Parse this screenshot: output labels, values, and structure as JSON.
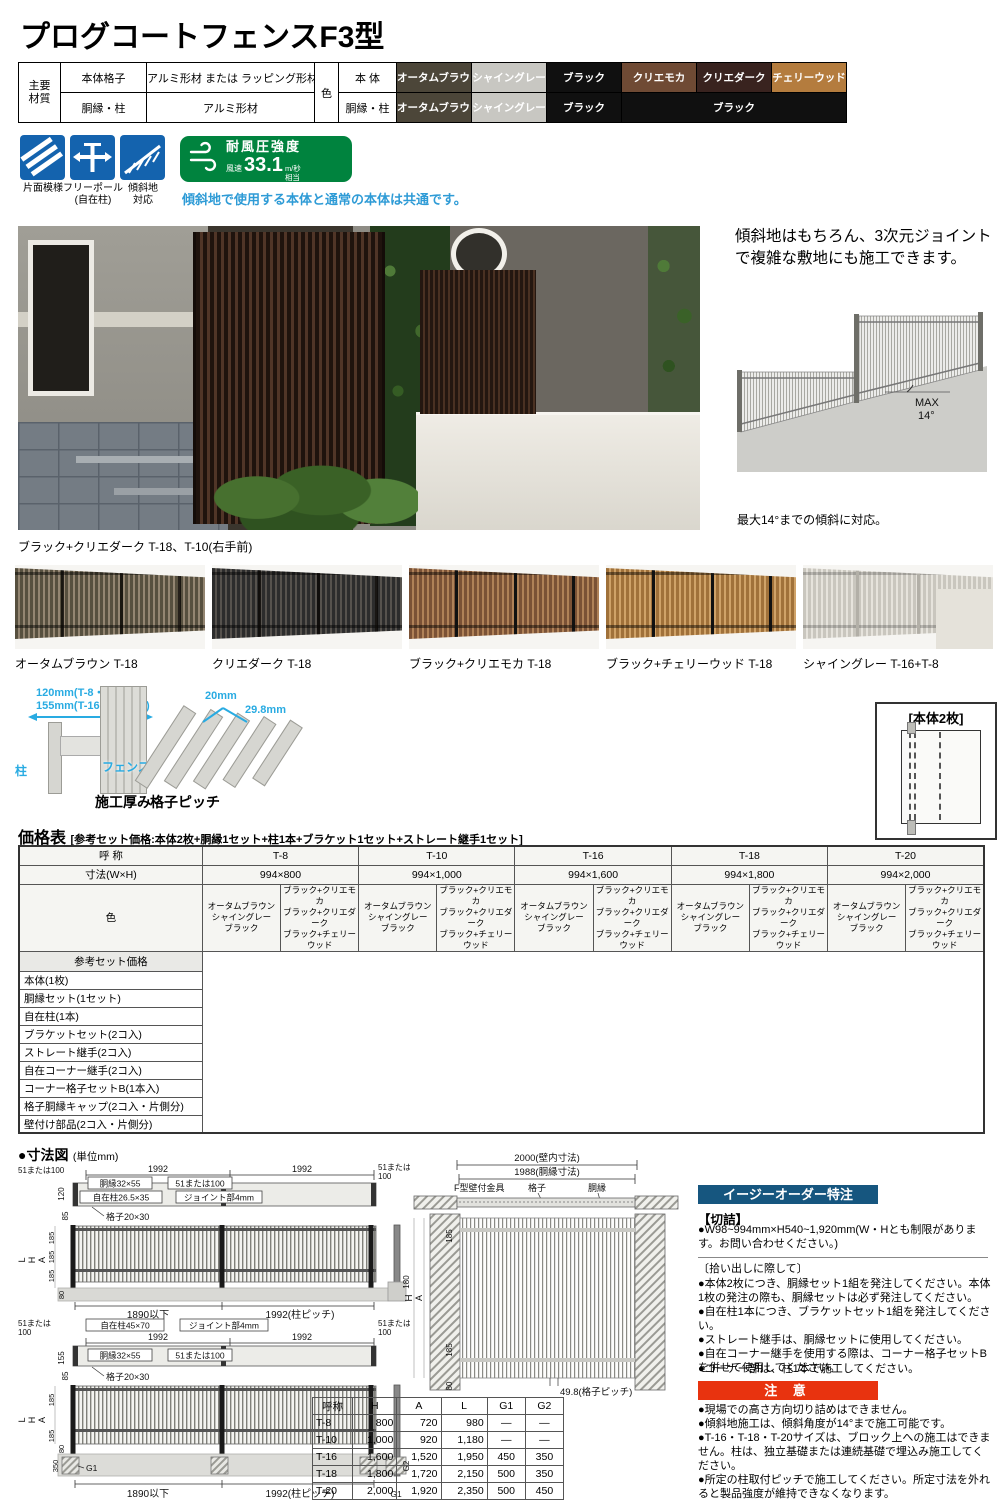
{
  "page": {
    "title": "プログコートフェンスF3型"
  },
  "colors": {
    "icon_blue": "#1463ae",
    "badge_green": "#00833e",
    "note_blue": "#2e9bd6",
    "easy_order_bar": "#16567f",
    "caution_bar": "#e8330f",
    "dim_cyan": "#29abe2"
  },
  "materials": {
    "group_label": "主要\n材質",
    "rows": [
      {
        "part": "本体格子",
        "material": "アルミ形材 または ラッピング形材"
      },
      {
        "part": "胴縁・柱",
        "material": "アルミ形材"
      }
    ],
    "color_label": "色",
    "body_label": "本 体",
    "frame_label": "胴縁・柱",
    "body_colors": [
      {
        "label": "オータムブラウン",
        "bg": "#4c4639"
      },
      {
        "label": "シャイングレー",
        "bg": "#c8c7c2"
      },
      {
        "label": "ブラック",
        "bg": "#101010"
      },
      {
        "label": "クリエモカ",
        "bg": "#6f4a34"
      },
      {
        "label": "クリエダーク",
        "bg": "#39231f"
      },
      {
        "label": "チェリーウッド",
        "bg": "#b47c3e"
      }
    ],
    "frame_colors": [
      {
        "label": "オータムブラウン",
        "bg": "#4c4639"
      },
      {
        "label": "シャイングレー",
        "bg": "#c8c7c2"
      },
      {
        "label": "ブラック",
        "bg": "#101010"
      },
      {
        "label": "ブラック",
        "bg": "#101010"
      }
    ]
  },
  "features": {
    "icons": [
      {
        "label": "片面模様"
      },
      {
        "label": "フリーポール\n(自在柱)"
      },
      {
        "label": "傾斜地\n対応"
      }
    ],
    "badge": {
      "title": "耐風圧強度",
      "prefix": "風速",
      "value": "33.1",
      "unit": "m/秒",
      "suffix": "相当"
    },
    "note": "傾斜地で使用する本体と通常の本体は共通です。"
  },
  "hero": {
    "caption": "ブラック+クリエダーク T-18、T-10(右手前)"
  },
  "slope": {
    "line1": "傾斜地はもちろん、3次元ジョイント",
    "line2": "で複雑な敷地にも施工できます。",
    "max1": "MAX",
    "max2": "14°",
    "caption": "最大14°までの傾斜に対応。"
  },
  "variations": [
    {
      "label": "オータムブラウン T-18"
    },
    {
      "label": "クリエダーク T-18"
    },
    {
      "label": "ブラック+クリエモカ T-18"
    },
    {
      "label": "ブラック+チェリーウッド T-18"
    },
    {
      "label": "シャイングレー T-16+T-8"
    }
  ],
  "detail": {
    "thickness": {
      "dim1": "120mm(T-8・10)",
      "dim2": "155mm(T-16・18・20)",
      "post": "柱",
      "fence": "フェンス",
      "caption": "施工厚み"
    },
    "pitch": {
      "dim1": "20mm",
      "dim2": "29.8mm",
      "caption": "格子ピッチ"
    },
    "panel_box": {
      "title": "[本体2枚]"
    }
  },
  "price_table": {
    "title": "価格表",
    "subtitle": "[参考セット価格:本体2枚+胴縁1セット+柱1本+ブラケット1セット+ストレート継手1セット]",
    "col_name": "呼 称",
    "col_dim": "寸法(W×H)",
    "col_color": "色",
    "sizes": [
      {
        "name": "T-8",
        "dim": "994×800"
      },
      {
        "name": "T-10",
        "dim": "994×1,000"
      },
      {
        "name": "T-16",
        "dim": "994×1,600"
      },
      {
        "name": "T-18",
        "dim": "994×1,800"
      },
      {
        "name": "T-20",
        "dim": "994×2,000"
      }
    ],
    "color_a": "オータムブラウン\nシャイングレー\nブラック",
    "color_b": "ブラック+クリエモカ\nブラック+クリエダーク\nブラック+チェリーウッド",
    "row_headers": [
      "参考セット価格",
      "本体(1枚)",
      "胴縁セット(1セット)",
      "自在柱(1本)",
      "ブラケットセット(2コ入)",
      "ストレート継手(2コ入)",
      "自在コーナー継手(2コ入)",
      "コーナー格子セットB(1本入)",
      "格子胴縁キャップ(2コ入・片側分)",
      "壁付け部品(2コ入・片側分)"
    ]
  },
  "dims_section": {
    "title": "●寸法図",
    "unit": "(単位mm)"
  },
  "dim1": {
    "e51l": "51または100",
    "w1": "1992",
    "w2": "1992",
    "e51r1": "51または",
    "e51r2": "100",
    "rail": "胴縁32×55",
    "j51": "51または100",
    "post": "自在柱26.5×35",
    "joint": "ジョイント部4mm",
    "v120": "120",
    "v85": "85",
    "grid": "格子20×30",
    "L": "L",
    "H": "H",
    "A": "A",
    "s185a": "185",
    "s185b": "185",
    "s185c": "185",
    "v80": "80",
    "under": "1890以下",
    "pitch": "1992(柱ピッチ)",
    "side": "180"
  },
  "dim2": {
    "e51l1": "51または",
    "e51l2": "100",
    "post": "自在柱45×70",
    "joint": "ジョイント部4mm",
    "e51r1": "51または",
    "e51r2": "100",
    "w1": "1992",
    "w2": "1992",
    "rail": "胴縁32×55",
    "j51": "51または100",
    "v155": "155",
    "v85": "85",
    "grid": "格子20×30",
    "L": "L",
    "H": "H",
    "A": "A",
    "s185a": "185",
    "s185b": "185",
    "v350": "350",
    "v80": "80",
    "g1": "G1",
    "under": "1890以下",
    "pitch": "1992(柱ピッチ)",
    "sideG2": "G2",
    "sideG1": "G1"
  },
  "wall": {
    "w2000": "2000(壁内寸法)",
    "w1988": "1988(胴縁寸法)",
    "bracket": "F型壁付金具",
    "grid": "格子",
    "rail": "胴縁",
    "s185a": "185",
    "H": "H",
    "A": "A",
    "s185b": "185",
    "v80": "80",
    "pitch": "49.8(格子ピッチ)"
  },
  "spec_table": {
    "headers": [
      "呼称",
      "H",
      "A",
      "L",
      "G1",
      "G2"
    ],
    "rows": [
      [
        "T-8",
        "800",
        "720",
        "980",
        "—",
        "—"
      ],
      [
        "T-10",
        "1,000",
        "920",
        "1,180",
        "—",
        "—"
      ],
      [
        "T-16",
        "1,600",
        "1,520",
        "1,950",
        "450",
        "350"
      ],
      [
        "T-18",
        "1,800",
        "1,720",
        "2,150",
        "500",
        "350"
      ],
      [
        "T-20",
        "2,000",
        "1,920",
        "2,350",
        "500",
        "450"
      ]
    ]
  },
  "easy_order": {
    "title": "イージーオーダー特注",
    "cut_head": "【切詰】",
    "cut_body": "●W98~994mm×H540~1,920mm(W・Hとも制限があります。お問い合わせください。)",
    "pickup_head": "〔拾い出しに際して〕",
    "pickup": [
      "●本体2枚につき、胴縁セット1組を発注してください。本体1枚の発注の際も、胴縁セットは必ず発注してください。",
      "●自在柱1本につき、ブラケットセット1組を発注してください。",
      "●ストレート継手は、胴縁セットに使用してください。",
      "●自在コーナー継手を使用する際は、コーナー格子セットBを併せて使用してください。"
    ],
    "corner": "●コーナー部は、柱1本で施工してください。"
  },
  "caution": {
    "title": "注 意",
    "items": [
      "●現場での高さ方向切り詰めはできません。",
      "●傾斜地施工は、傾斜角度が14°まで施工可能です。",
      "●T-16・T-18・T-20サイズは、ブロック上への施工はできません。柱は、独立基礎または連続基礎で埋込み施工してください。",
      "●所定の柱取付ピッチで施工してください。所定寸法を外れると製品強度が維持できなくなります。"
    ]
  }
}
